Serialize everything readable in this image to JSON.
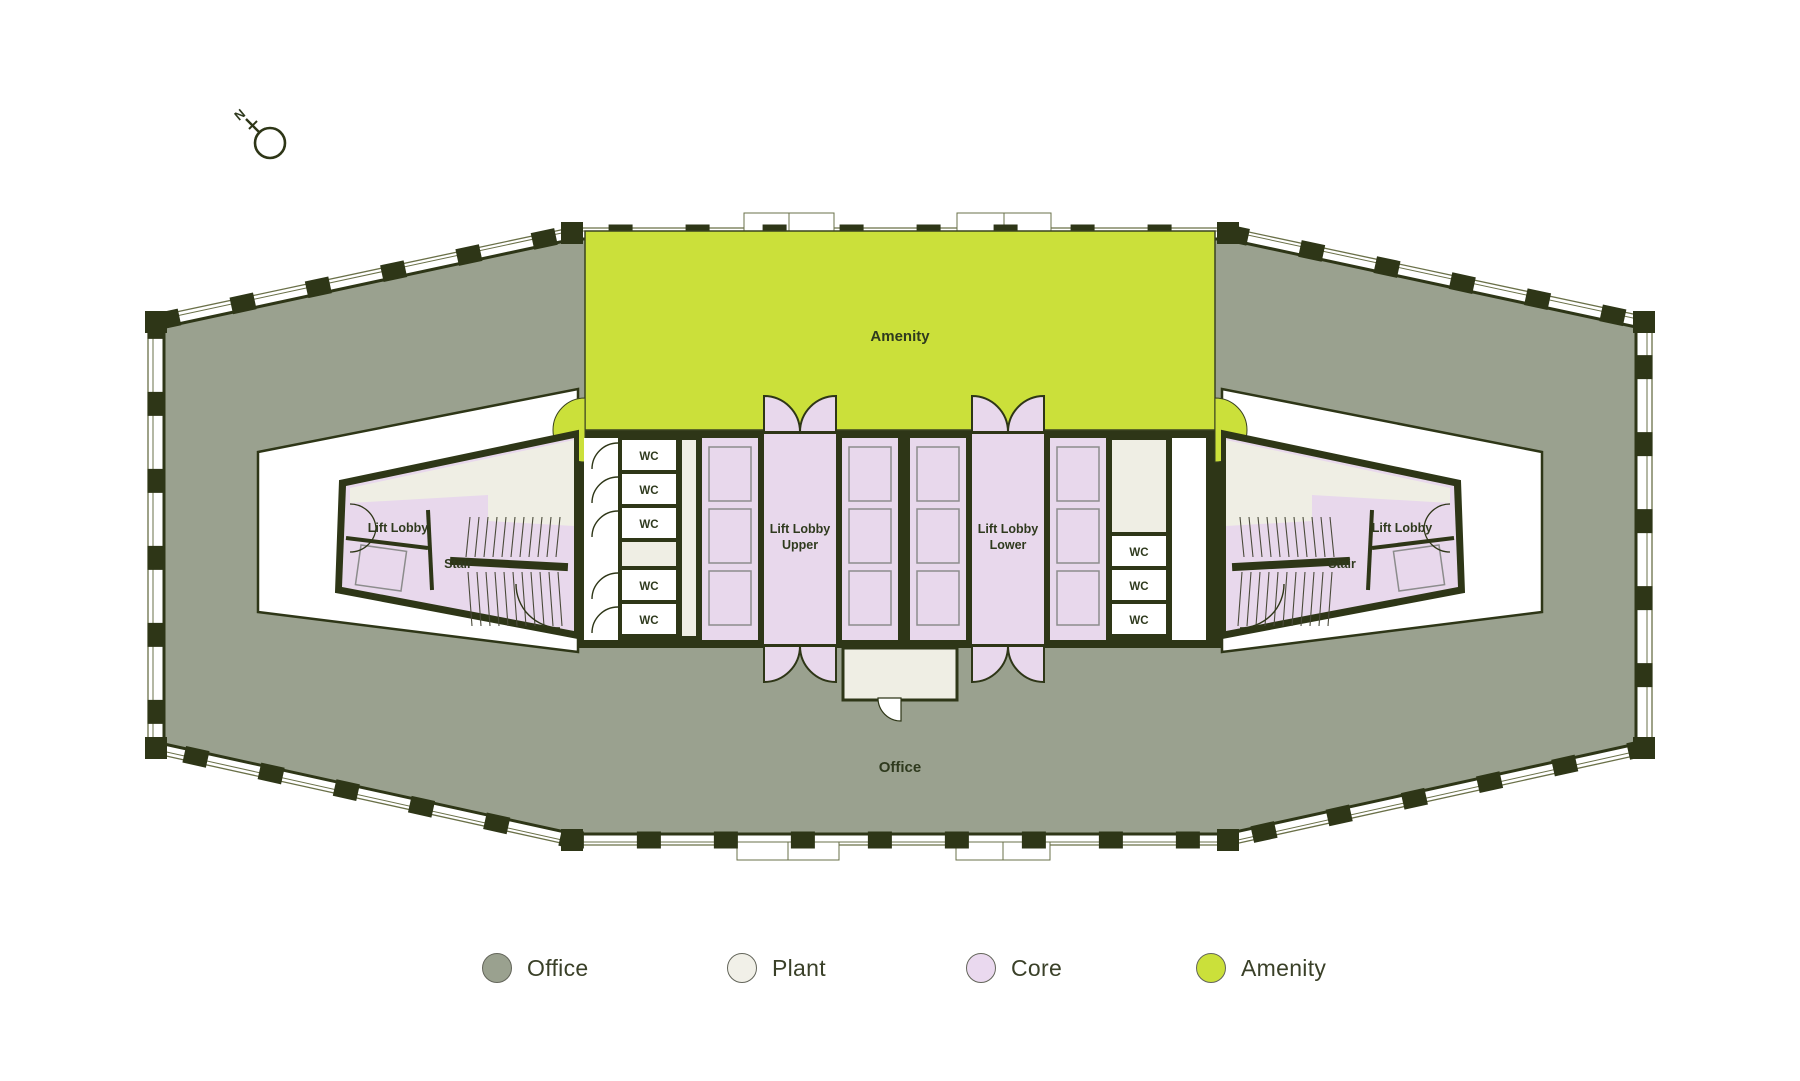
{
  "compass": {
    "label": "N"
  },
  "colors": {
    "office": "#9AA18F",
    "plant": "#EFEEE4",
    "core": "#E8D8EC",
    "amenity": "#CBE03A",
    "wall": "#2E3617",
    "thin_line": "#6A7048",
    "label": "#2F3A1E",
    "car_line": "#8C8C8C",
    "background": "#FFFFFF"
  },
  "plan_labels": {
    "amenity": "Amenity",
    "office": "Office",
    "wc": "WC",
    "stair": "Stair",
    "lift_lobby": "Lift Lobby",
    "lift_lobby_upper_line1": "Lift Lobby",
    "lift_lobby_upper_line2": "Upper",
    "lift_lobby_lower_line1": "Lift Lobby",
    "lift_lobby_lower_line2": "Lower"
  },
  "legend": {
    "items": [
      {
        "label": "Office",
        "color": "#9AA18F"
      },
      {
        "label": "Plant",
        "color": "#F1F0E8"
      },
      {
        "label": "Core",
        "color": "#EAD9EF"
      },
      {
        "label": "Amenity",
        "color": "#CBE03A"
      }
    ]
  }
}
